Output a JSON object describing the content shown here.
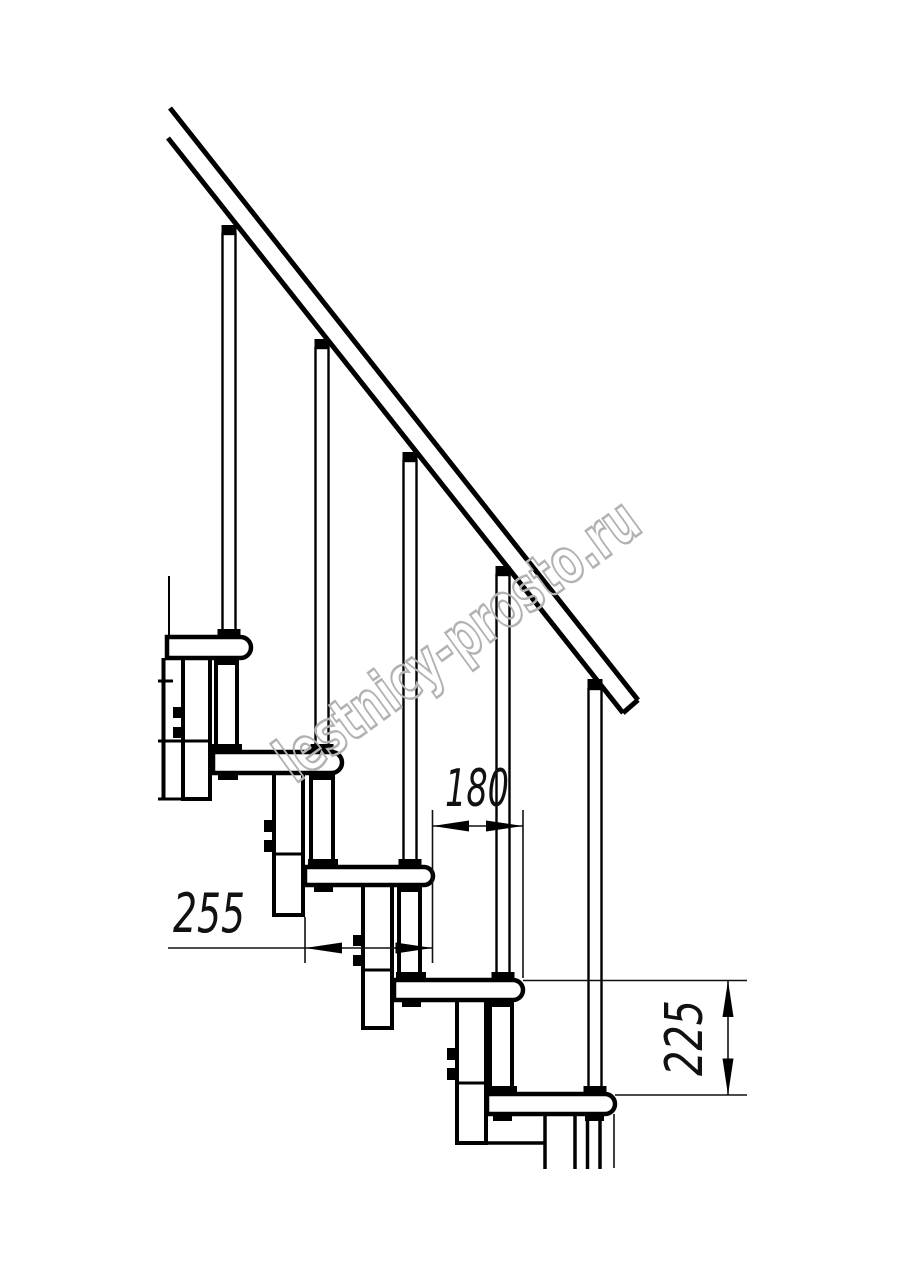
{
  "drawing": {
    "type": "technical line drawing",
    "subject": "Modular staircase side elevation: handrail, balusters, treads, support posts",
    "background_color": "#ffffff",
    "line_color": "#000000"
  },
  "watermark": {
    "text": "lestnicy-prosto.ru",
    "color": "#b2b2b2"
  },
  "dimensions": {
    "step_run": {
      "label": "180",
      "orientation": "horizontal"
    },
    "tread_depth": {
      "label": "255",
      "orientation": "horizontal"
    },
    "step_rise": {
      "label": "225",
      "orientation": "vertical"
    }
  }
}
